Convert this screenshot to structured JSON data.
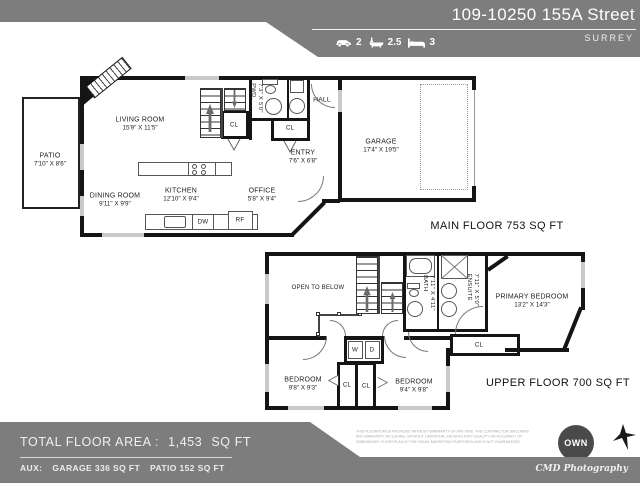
{
  "header": {
    "address": "109-10250 155A Street",
    "city": "SURREY",
    "stats": {
      "garage": "2",
      "bath": "2.5",
      "bed": "3"
    }
  },
  "labels": {
    "closet": "CL",
    "hall": "HALL",
    "dishwasher": "DW",
    "fridge": "RF",
    "washer": "W",
    "dryer": "D"
  },
  "main_floor": {
    "title": "MAIN FLOOR  753 SQ FT",
    "patio": {
      "name": "PATIO",
      "dims": "7'10\" X 8'6\""
    },
    "living_room": {
      "name": "LIVING ROOM",
      "dims": "15'9\" X 11'5\""
    },
    "dining_room": {
      "name": "DINING ROOM",
      "dims": "9'11\" X 9'9\""
    },
    "kitchen": {
      "name": "KITCHEN",
      "dims": "12'10\" X 9'4\""
    },
    "office": {
      "name": "OFFICE",
      "dims": "5'8\" X 9'4\""
    },
    "entry": {
      "name": "ENTRY",
      "dims": "7'6\" X 6'8\""
    },
    "garage": {
      "name": "GARAGE",
      "dims": "17'4\" X 19'5\""
    },
    "powder": {
      "name": "PWD.",
      "dims": "7'3\" X 5'0\""
    }
  },
  "upper_floor": {
    "title": "UPPER FLOOR  700 SQ FT",
    "open_to_below": "OPEN TO BELOW",
    "bath": {
      "name": "BATH",
      "dims": "7'11\" X 4'11\""
    },
    "ensuite": {
      "name": "ENSUITE",
      "dims": "7'11\" X 5'0\""
    },
    "primary_bedroom": {
      "name": "PRIMARY BEDROOM",
      "dims": "13'2\" X 14'3\""
    },
    "bedroom_left": {
      "name": "BEDROOM",
      "dims": "9'8\" X 9'3\""
    },
    "bedroom_right": {
      "name": "BEDROOM",
      "dims": "9'4\" X 9'8\""
    }
  },
  "footer": {
    "total_label": "TOTAL FLOOR AREA :",
    "total_value": "1,453",
    "total_unit": "SQ FT",
    "aux_label": "AUX:",
    "aux_garage": "GARAGE  336 SQ FT",
    "aux_patio": "PATIO  152 SQ FT",
    "disclaimer": "THIS FLOORPLAN IS PROVIDED WITHOUT WARRANTY OF ANY KIND. THE CONTRACTOR DISCLAIMS ANY WARRANTY INCLUDING, WITHOUT LIMITATION, SATISFACTORY QUALITY OR ACCURACY OF DIMENSIONS. FLOOR PLAN IS FOR VISUAL MARKETING PURPOSES AND IS NOT GUARANTEED",
    "credit": "CMD Photography"
  },
  "logos": {
    "own": "OWN"
  },
  "colors": {
    "band_gray": "#7d7d7d",
    "wall_black": "#151515",
    "window_gray": "#c9c9c9"
  }
}
